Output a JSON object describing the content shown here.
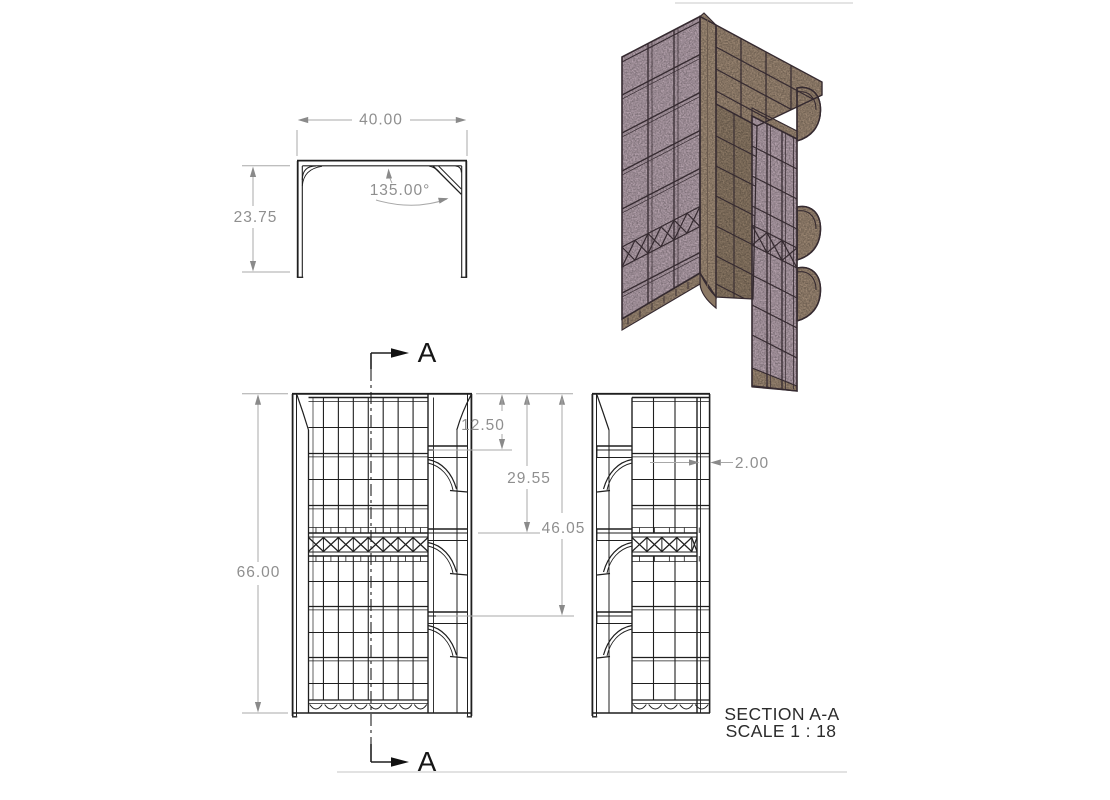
{
  "views": {
    "plan": {
      "width": "40.00",
      "height": "23.75",
      "angle": "135.00°"
    },
    "front": {
      "overall_height": "66.00",
      "offset_bracket1": "12.50",
      "offset_band": "29.55",
      "offset_bracket3": "46.05",
      "section_marker": "A"
    },
    "section": {
      "wall_thickness": "2.00",
      "caption_title": "SECTION A-A",
      "caption_scale": "SCALE 1 : 18"
    }
  },
  "colors": {
    "line_ink": "#1f1f1f",
    "dimension_gray": "#8f8f8f",
    "panel_pink": "#b4a1ac",
    "panel_tan": "#9c8773",
    "panel_tan_dark": "#8c7965",
    "corner_post_tan": "#a18c77"
  }
}
